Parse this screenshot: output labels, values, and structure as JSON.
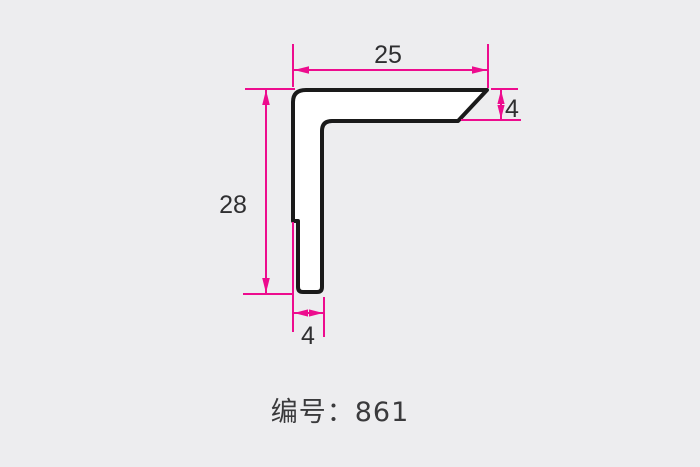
{
  "drawing": {
    "type": "profile-cross-section",
    "label": "编号：861",
    "part_number": "861",
    "dimensions": [
      {
        "id": "top-width",
        "value": "25"
      },
      {
        "id": "right-thickness",
        "value": "4"
      },
      {
        "id": "left-height",
        "value": "28"
      },
      {
        "id": "bottom-thickness",
        "value": "4"
      }
    ],
    "colors": {
      "page_background": "#ededef",
      "dimension_line": "#ed0c8e",
      "dimension_text": "#2f2f31",
      "profile_outline": "#1a1a1a",
      "profile_fill": "#ffffff",
      "label_text": "#3a3a3c"
    }
  }
}
